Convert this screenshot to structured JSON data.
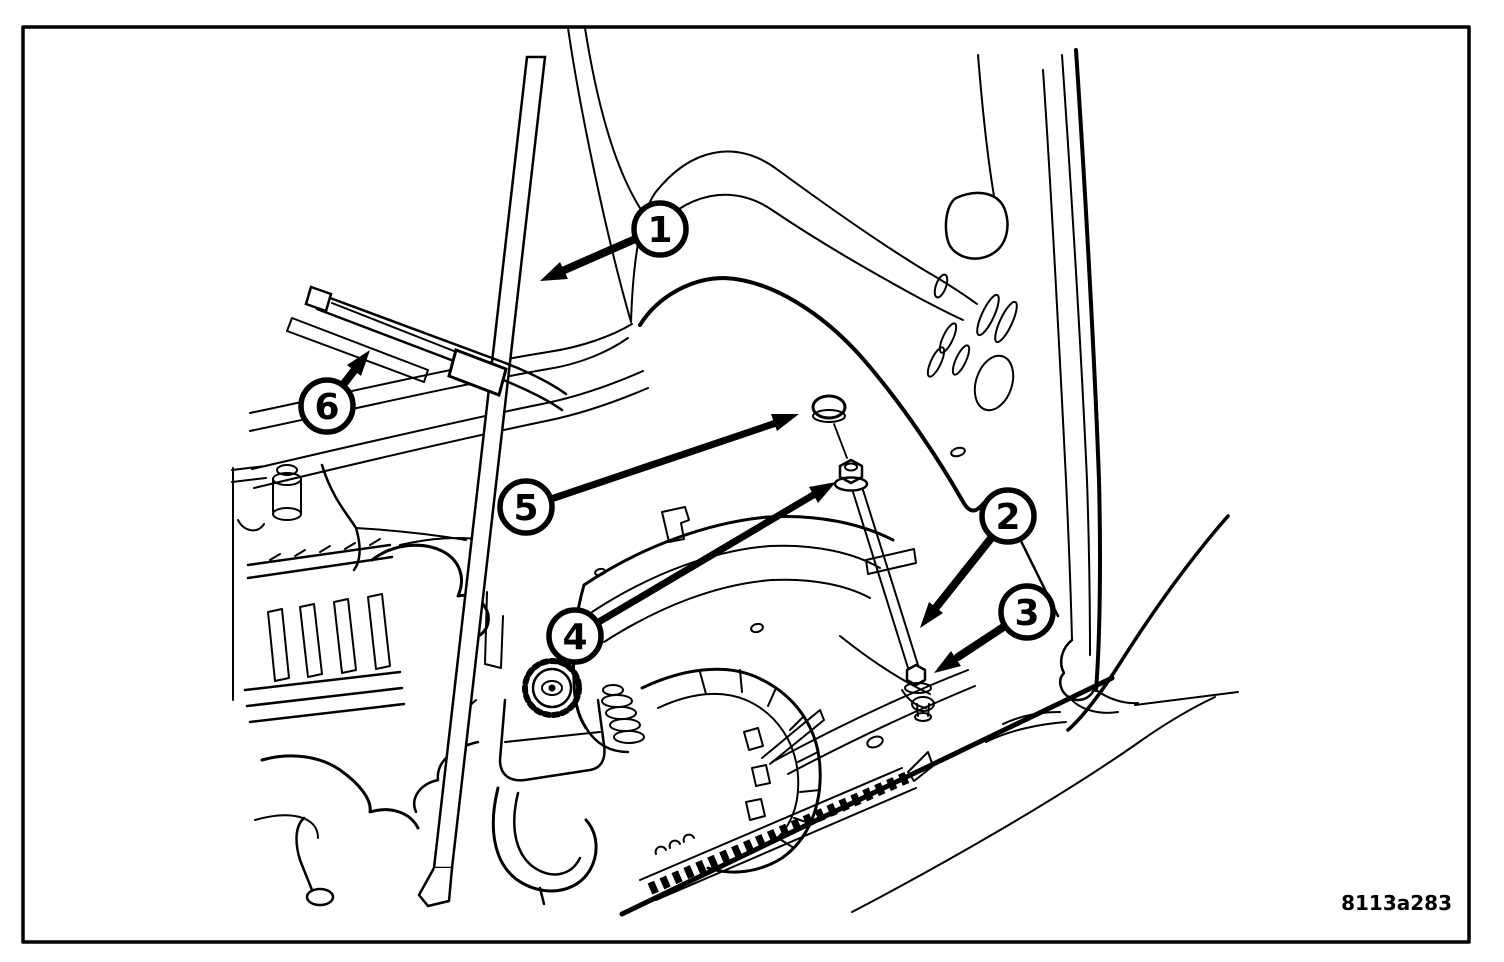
{
  "figure": {
    "label": "8113a283",
    "description": "Engine compartment line illustration of hood prop rod and gas strut attachment",
    "background_color": "#ffffff",
    "line_color": "#000000"
  },
  "callouts": [
    {
      "number": "1",
      "target": "hood-prop-rod"
    },
    {
      "number": "2",
      "target": "gas-strut-rod"
    },
    {
      "number": "3",
      "target": "strut-lower-mount-bolt"
    },
    {
      "number": "4",
      "target": "ball-stud-nut"
    },
    {
      "number": "5",
      "target": "ball-stud-cap"
    },
    {
      "number": "6",
      "target": "wiper-arm"
    }
  ]
}
